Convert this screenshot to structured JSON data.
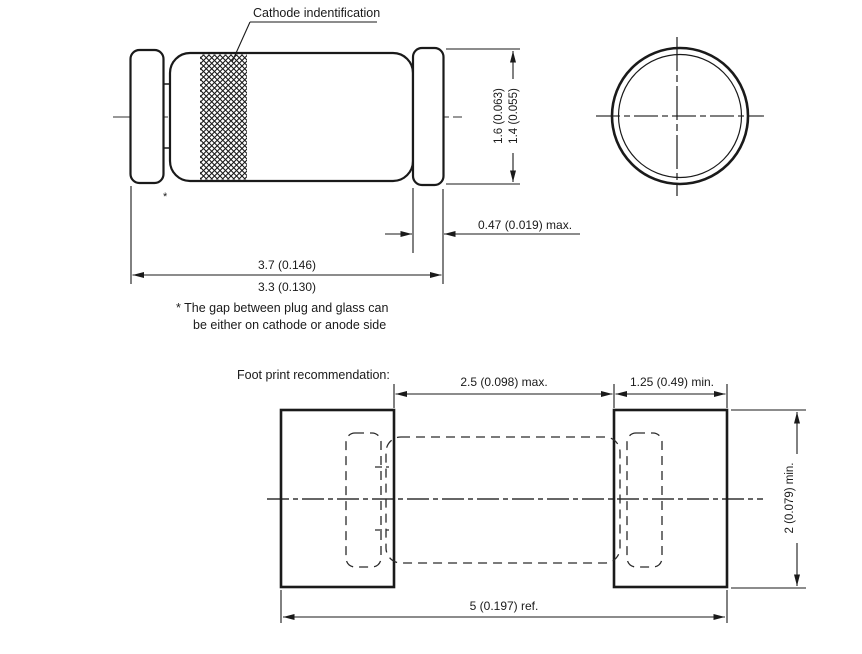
{
  "title_callout": "Cathode indentification",
  "side_view": {
    "dia_outer": "1.6 (0.063)",
    "dia_inner": "1.4 (0.055)",
    "cap_width": "0.47 (0.019) max.",
    "length_max": "3.7 (0.146)",
    "length_min": "3.3 (0.130)",
    "gap_marker": "*"
  },
  "note": {
    "line1": "* The gap between plug and glass can",
    "line2": "be either on cathode or anode side"
  },
  "footprint": {
    "heading": "Foot print recommendation:",
    "gap_between_pads": "2.5 (0.098) max.",
    "pad_width": "1.25 (0.49) min.",
    "overall_length": "5 (0.197) ref.",
    "pad_height": "2 (0.079) min."
  },
  "colors": {
    "line": "#1a1a1a",
    "centerline": "#777777",
    "background": "#ffffff"
  }
}
